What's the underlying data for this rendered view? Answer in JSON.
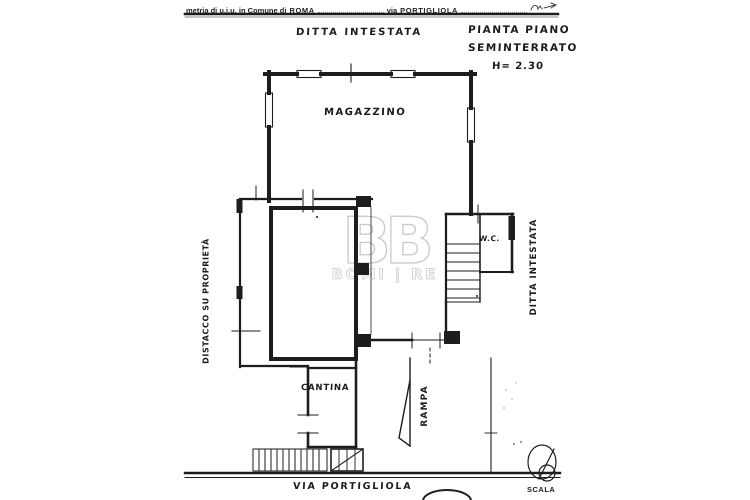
{
  "header": {
    "form_text": "metria di u.i.u. in Comune di",
    "city": "ROMA",
    "via_label": "via",
    "street": "PORTIGLIOLA"
  },
  "title_block": {
    "line1": "PIANTA PIANO",
    "line2": "SEMINTERRATO",
    "height_note": "H= 2.30"
  },
  "labels": {
    "owner_top": "DITTA INTESTATA",
    "owner_right": "DITTA INTESTATA",
    "setback_left": "DISTACCO SU PROPRIETÀ",
    "warehouse": "MAGAZZINO",
    "cellar": "CANTINA",
    "wc": "W.C.",
    "ramp": "RAMPA",
    "street_bottom": "VIA PORTIGLIOLA",
    "scale_label": "SCALA"
  },
  "watermark": {
    "logo": "BB",
    "name": "BOMI | RE"
  },
  "colors": {
    "ink": "#1d1d1d",
    "paper": "#ffffff",
    "watermark": "#c9c9c9"
  }
}
